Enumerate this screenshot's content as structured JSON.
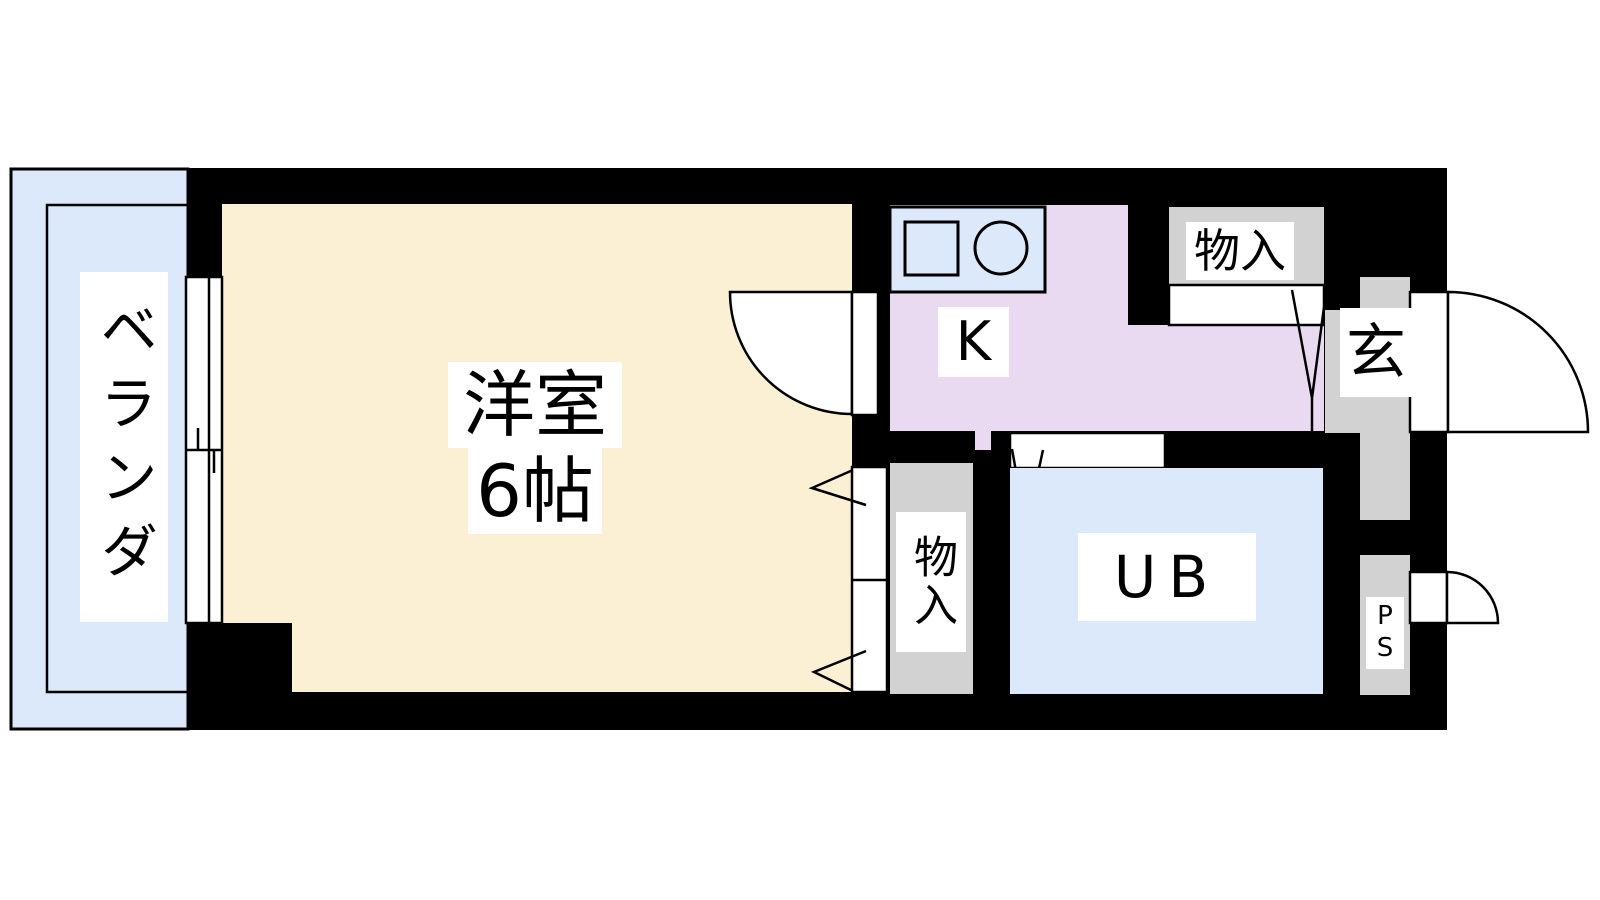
{
  "title": "apartment-floor-plan",
  "rooms": {
    "veranda": {
      "label": "ベランダ"
    },
    "western_room": {
      "label": "洋室",
      "size_label": "6帖"
    },
    "kitchen": {
      "label": "K"
    },
    "closet_top": {
      "label": "物入"
    },
    "closet_mid": {
      "label": "物入"
    },
    "entrance": {
      "label": "玄"
    },
    "unit_bath": {
      "label": "UB"
    },
    "pipe_space": {
      "label": "PS"
    }
  },
  "icons": {
    "stove": "stove-square-icon",
    "sink": "sink-circle-icon"
  },
  "colors": {
    "wall": "#000000",
    "cream": "#fcf0d4",
    "blue": "#dce9fa",
    "lavender": "#eadaf1",
    "gray": "#d2d2d2",
    "background": "#ffffff"
  }
}
